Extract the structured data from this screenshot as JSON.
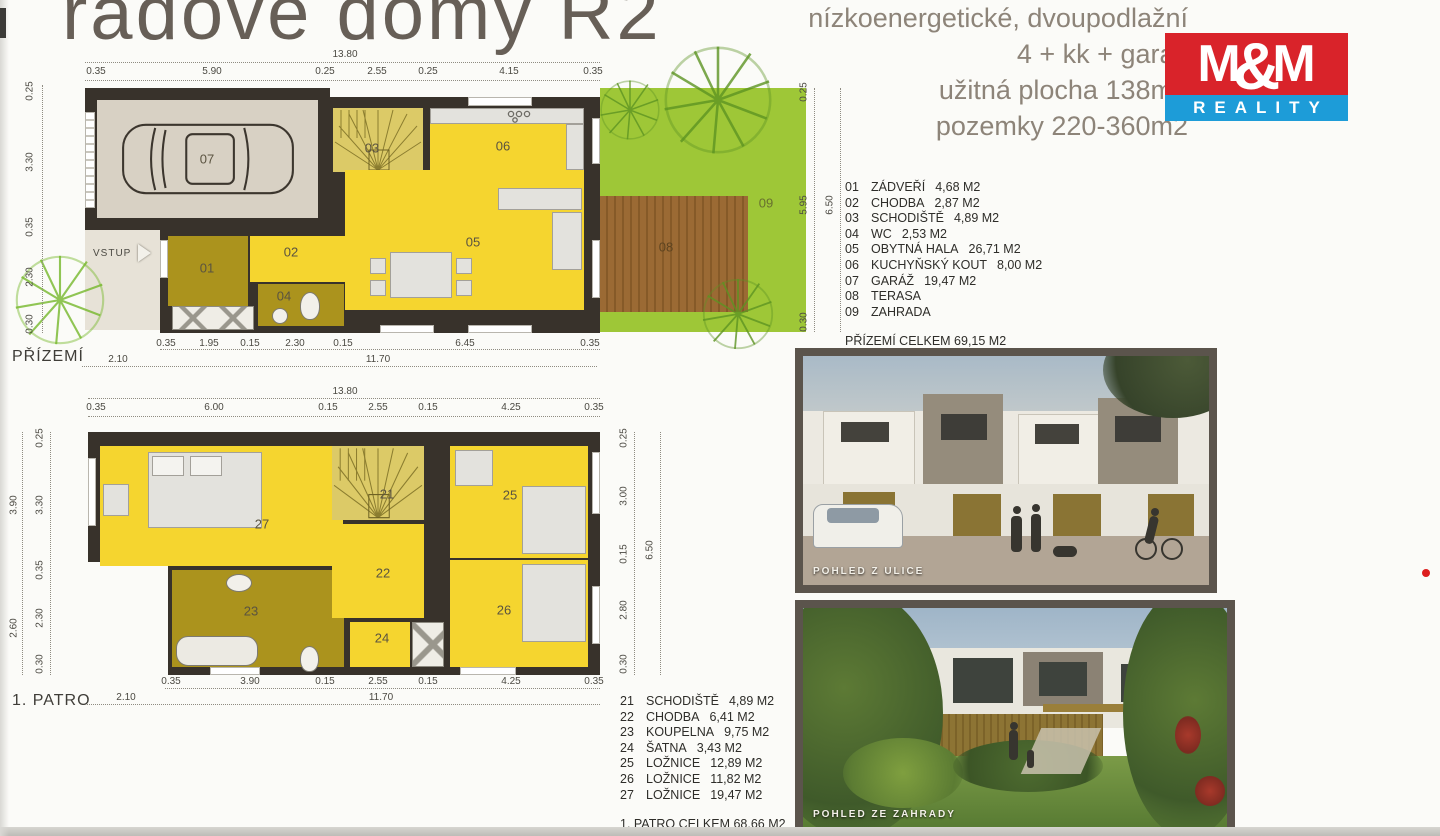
{
  "header": {
    "title": "řadové domy R2",
    "subtitle_lines": [
      "nízkoenergetické, dvoupodlažní",
      "4 + kk + garáž",
      "užitná plocha 138m2",
      "pozemky 220-360m2"
    ],
    "logo": {
      "m1": "M",
      "amp": "&",
      "m2": "M",
      "reality": "REALITY"
    }
  },
  "ground_floor": {
    "name_label": "PŘÍZEMÍ",
    "entrance_label": "VSTUP",
    "plan_labels": [
      "01",
      "02",
      "03",
      "04",
      "05",
      "06",
      "07",
      "08",
      "09"
    ],
    "dims": {
      "top_total": "13.80",
      "top": [
        "0.35",
        "5.90",
        "0.25",
        "2.55",
        "0.25",
        "4.15",
        "0.35"
      ],
      "bottom": [
        "0.35",
        "1.95",
        "0.15",
        "2.30",
        "0.15",
        "6.45",
        "0.35"
      ],
      "bottom_totals": [
        "2.10",
        "11.70"
      ],
      "left": [
        "0.25",
        "3.30",
        "0.35",
        "2.30",
        "0.30"
      ],
      "right": [
        "0.25",
        "5.95",
        "0.30"
      ],
      "right_total": "6.50"
    },
    "legend": [
      {
        "num": "01",
        "name": "ZÁDVEŘÍ",
        "area": "4,68 M2"
      },
      {
        "num": "02",
        "name": "CHODBA",
        "area": "2,87 M2"
      },
      {
        "num": "03",
        "name": "SCHODIŠTĚ",
        "area": "4,89 M2"
      },
      {
        "num": "04",
        "name": "WC",
        "area": "2,53 M2"
      },
      {
        "num": "05",
        "name": "OBYTNÁ HALA",
        "area": "26,71 M2"
      },
      {
        "num": "06",
        "name": "KUCHYŇSKÝ KOUT",
        "area": "8,00 M2"
      },
      {
        "num": "07",
        "name": "GARÁŽ",
        "area": "19,47 M2"
      },
      {
        "num": "08",
        "name": "TERASA",
        "area": ""
      },
      {
        "num": "09",
        "name": "ZAHRADA",
        "area": ""
      }
    ],
    "total": "PŘÍZEMÍ CELKEM  69,15 M2"
  },
  "first_floor": {
    "name_label": "1. PATRO",
    "plan_labels": [
      "21",
      "22",
      "23",
      "24",
      "25",
      "26",
      "27"
    ],
    "dims": {
      "top_total": "13.80",
      "top": [
        "0.35",
        "6.00",
        "0.15",
        "2.55",
        "0.15",
        "4.25",
        "0.35"
      ],
      "bottom": [
        "0.35",
        "3.90",
        "0.15",
        "2.55",
        "0.15",
        "4.25",
        "0.35"
      ],
      "bottom_totals": [
        "2.10",
        "11.70"
      ],
      "left_outer": [
        "3.90",
        "2.60"
      ],
      "left_inner": [
        "0.25",
        "3.30",
        "0.35",
        "2.30",
        "0.30"
      ],
      "right_inner": [
        "0.25",
        "3.00",
        "0.15",
        "2.80",
        "0.30"
      ],
      "right_total": "6.50"
    },
    "legend": [
      {
        "num": "21",
        "name": "SCHODIŠTĚ",
        "area": "4,89 M2"
      },
      {
        "num": "22",
        "name": "CHODBA",
        "area": "6,41 M2"
      },
      {
        "num": "23",
        "name": "KOUPELNA",
        "area": "9,75 M2"
      },
      {
        "num": "24",
        "name": "ŠATNA",
        "area": "3,43 M2"
      },
      {
        "num": "25",
        "name": "LOŽNICE",
        "area": "12,89 M2"
      },
      {
        "num": "26",
        "name": "LOŽNICE",
        "area": "11,82 M2"
      },
      {
        "num": "27",
        "name": "LOŽNICE",
        "area": "19,47 M2"
      }
    ],
    "total": "1. PATRO CELKEM  68,66 M2"
  },
  "photos": {
    "street_caption": "POHLED Z ULICE",
    "garden_caption": "POHLED ZE ZAHRADY"
  },
  "colors": {
    "logo_red": "#d9232a",
    "logo_blue": "#1d9cd8",
    "plan_yellow": "#f5d52f",
    "plan_olive": "#ab931d",
    "plan_green": "#9ec737",
    "terrace_brown": "#9b6a34",
    "wall_dark": "#38322b"
  }
}
